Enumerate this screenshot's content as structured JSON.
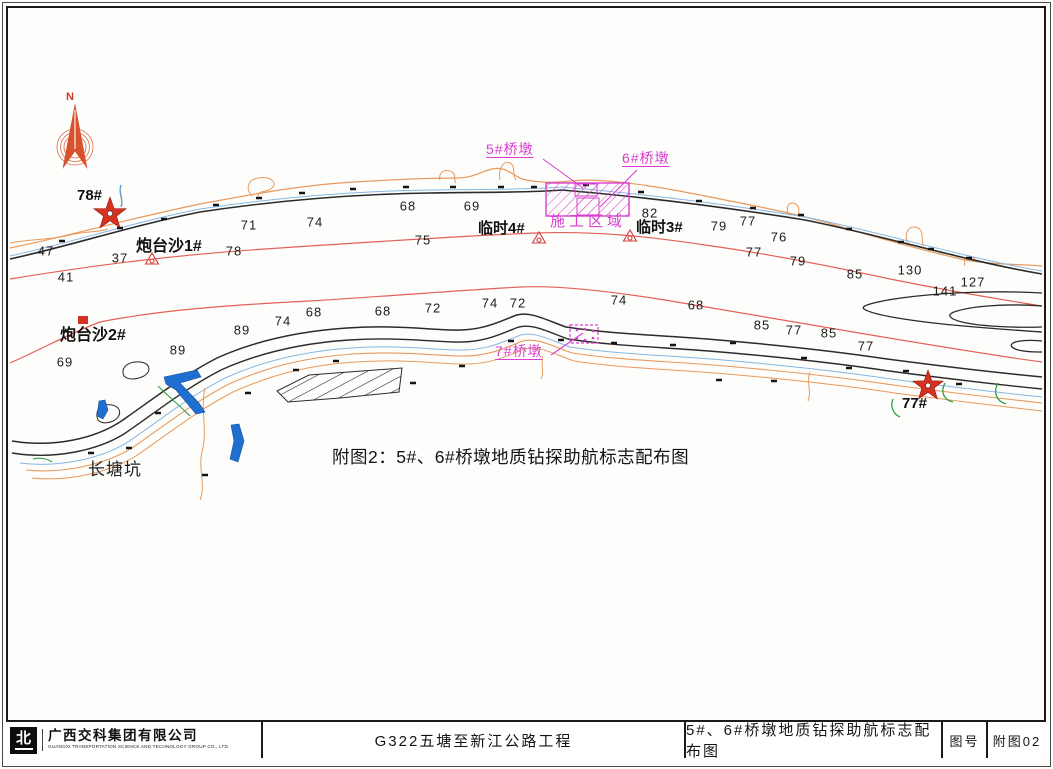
{
  "page": {
    "width": 1053,
    "height": 769,
    "kind": "engineering navigation-aid layout drawing"
  },
  "map": {
    "caption": "附图2：5#、6#桥墩地质钻探助航标志配布图",
    "colors": {
      "channel_line_red": "#e4615a",
      "construction_magenta": "#d83fd0",
      "contour_orange": "#e8995c",
      "water_blue": "#86b6e4",
      "creek_fill_blue": "#1e6fd0",
      "vegetation_green": "#2f9e44",
      "marker_red": "#d6301f"
    },
    "labels": [
      {
        "name": "north-label",
        "text": "N",
        "x": 66,
        "y": 92,
        "fs": 11,
        "color": "#cc3b22",
        "fw": 700,
        "ls": 0,
        "u": false
      },
      {
        "name": "beacon-78-label",
        "text": "78#",
        "x": 77,
        "y": 188,
        "fs": 15,
        "color": "#111111",
        "fw": 600,
        "ls": 0,
        "u": false
      },
      {
        "name": "beacon-77-label",
        "text": "77#",
        "x": 902,
        "y": 396,
        "fs": 15,
        "color": "#111111",
        "fw": 600,
        "ls": 0,
        "u": false
      },
      {
        "name": "paotaisha-1-label",
        "text": "炮台沙1#",
        "x": 136,
        "y": 239,
        "fs": 16,
        "color": "#111111",
        "fw": 700,
        "ls": 0,
        "u": false
      },
      {
        "name": "paotaisha-2-label",
        "text": "炮台沙2#",
        "x": 60,
        "y": 328,
        "fs": 16,
        "color": "#111111",
        "fw": 700,
        "ls": 0,
        "u": false
      },
      {
        "name": "linshi-4-label",
        "text": "临时4#",
        "x": 478,
        "y": 221,
        "fs": 15,
        "color": "#111111",
        "fw": 700,
        "ls": 0,
        "u": false
      },
      {
        "name": "linshi-3-label",
        "text": "临时3#",
        "x": 636,
        "y": 220,
        "fs": 15,
        "color": "#111111",
        "fw": 700,
        "ls": 0,
        "u": false
      },
      {
        "name": "changtangkeng-label",
        "text": "长塘坑",
        "x": 88,
        "y": 461,
        "fs": 17,
        "color": "#222222",
        "fw": 400,
        "ls": 1,
        "u": false
      },
      {
        "name": "pier-5-label",
        "text": "5#桥墩",
        "x": 486,
        "y": 142,
        "fs": 14,
        "color": "#d83fd0",
        "fw": 400,
        "ls": 1,
        "u": true
      },
      {
        "name": "pier-6-label",
        "text": "6#桥墩",
        "x": 622,
        "y": 151,
        "fs": 14,
        "color": "#d83fd0",
        "fw": 400,
        "ls": 1,
        "u": true
      },
      {
        "name": "pier-7-label",
        "text": "7#桥墩",
        "x": 495,
        "y": 344,
        "fs": 14,
        "color": "#d83fd0",
        "fw": 400,
        "ls": 1,
        "u": true
      },
      {
        "name": "construction-area-label",
        "text": "施工区域",
        "x": 550,
        "y": 214,
        "fs": 15,
        "color": "#d83fd0",
        "fw": 400,
        "ls": 4,
        "u": false
      }
    ],
    "soundings": [
      {
        "v": "47",
        "x": 46,
        "y": 251
      },
      {
        "v": "37",
        "x": 120,
        "y": 258
      },
      {
        "v": "41",
        "x": 66,
        "y": 277
      },
      {
        "v": "78",
        "x": 234,
        "y": 251
      },
      {
        "v": "71",
        "x": 249,
        "y": 225
      },
      {
        "v": "74",
        "x": 315,
        "y": 222
      },
      {
        "v": "68",
        "x": 408,
        "y": 206
      },
      {
        "v": "69",
        "x": 472,
        "y": 206
      },
      {
        "v": "75",
        "x": 423,
        "y": 240
      },
      {
        "v": "82",
        "x": 650,
        "y": 213
      },
      {
        "v": "79",
        "x": 719,
        "y": 226
      },
      {
        "v": "77",
        "x": 748,
        "y": 221
      },
      {
        "v": "76",
        "x": 779,
        "y": 237
      },
      {
        "v": "77",
        "x": 754,
        "y": 252
      },
      {
        "v": "79",
        "x": 798,
        "y": 261
      },
      {
        "v": "85",
        "x": 855,
        "y": 274
      },
      {
        "v": "130",
        "x": 910,
        "y": 270
      },
      {
        "v": "141",
        "x": 945,
        "y": 291
      },
      {
        "v": "127",
        "x": 973,
        "y": 282
      },
      {
        "v": "69",
        "x": 65,
        "y": 362
      },
      {
        "v": "89",
        "x": 178,
        "y": 350
      },
      {
        "v": "89",
        "x": 242,
        "y": 330
      },
      {
        "v": "74",
        "x": 283,
        "y": 321
      },
      {
        "v": "68",
        "x": 314,
        "y": 312
      },
      {
        "v": "68",
        "x": 383,
        "y": 311
      },
      {
        "v": "72",
        "x": 433,
        "y": 308
      },
      {
        "v": "74",
        "x": 490,
        "y": 303
      },
      {
        "v": "72",
        "x": 518,
        "y": 303
      },
      {
        "v": "74",
        "x": 619,
        "y": 300
      },
      {
        "v": "68",
        "x": 696,
        "y": 305
      },
      {
        "v": "85",
        "x": 762,
        "y": 325
      },
      {
        "v": "77",
        "x": 794,
        "y": 330
      },
      {
        "v": "85",
        "x": 829,
        "y": 333
      },
      {
        "v": "77",
        "x": 866,
        "y": 346
      }
    ],
    "markers": [
      {
        "name": "beacon-78",
        "label": "78#",
        "type": "star",
        "x": 110,
        "y": 214
      },
      {
        "name": "beacon-77",
        "label": "77#",
        "type": "star",
        "x": 928,
        "y": 386
      },
      {
        "name": "paotaisha-1",
        "label": "炮台沙1#",
        "type": "triangle-buoy",
        "x": 152,
        "y": 259
      },
      {
        "name": "paotaisha-2",
        "label": "炮台沙2#",
        "type": "square-beacon",
        "x": 83,
        "y": 320
      },
      {
        "name": "linshi-4",
        "label": "临时4#",
        "type": "triangle-buoy",
        "x": 539,
        "y": 238
      },
      {
        "name": "linshi-3",
        "label": "临时3#",
        "type": "triangle-buoy",
        "x": 630,
        "y": 236
      },
      {
        "name": "construction-area",
        "label": "施工区域",
        "type": "hatched-rect",
        "x": 587,
        "y": 199
      },
      {
        "name": "pier-7-box",
        "label": "7#桥墩",
        "type": "dashed-rect",
        "x": 584,
        "y": 334
      }
    ]
  },
  "title_bar": {
    "logo_glyph": "北",
    "company": "广西交科集团有限公司",
    "company_en": "GUANGXI TRANSPORTATION SCIENCE AND TECHNOLOGY GROUP CO., LTD.",
    "project": "G322五塘至新江公路工程",
    "drawing_title": "5#、6#桥墩地质钻探助航标志配布图",
    "fig_no_label": "图号",
    "fig_no_value": "附图02"
  }
}
